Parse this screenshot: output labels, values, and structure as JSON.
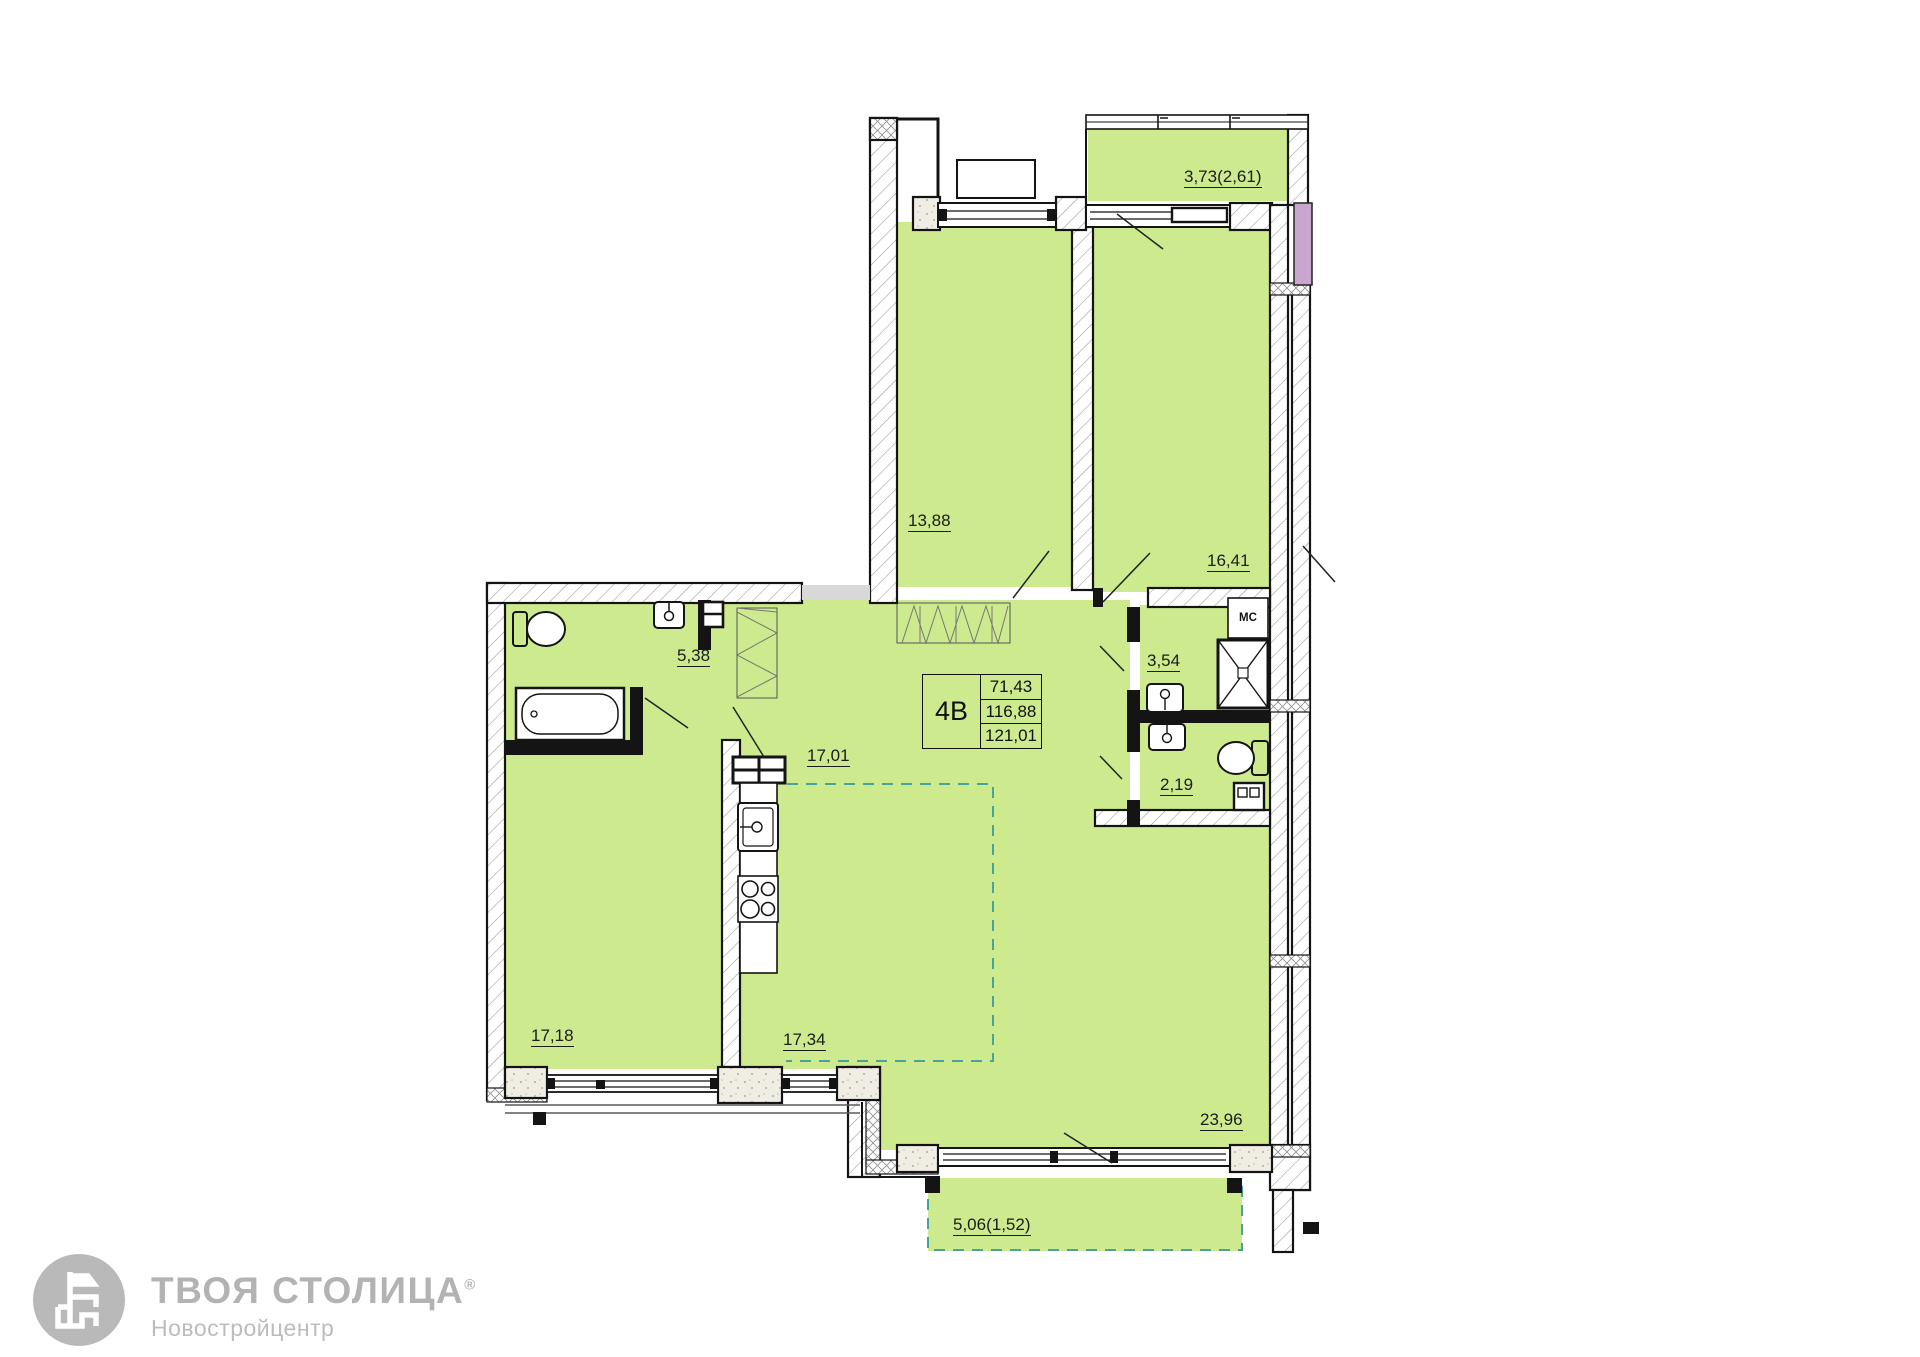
{
  "plan": {
    "unit": {
      "type_label": "4В",
      "area_living": "71,43",
      "area_total": "116,88",
      "area_with_balcony": "121,01"
    },
    "room_areas": {
      "bedroom_top": "13,88",
      "bedroom_right": "16,41",
      "loggia_top": "3,73(2,61)",
      "bathroom": "5,38",
      "hall": "17,01",
      "shower_room": "3,54",
      "wc": "2,19",
      "bedroom_bottom": "17,18",
      "kitchen": "17,34",
      "living_room": "23,96",
      "loggia_bottom": "5,06(1,52)"
    },
    "shaft_label": "МС"
  },
  "branding": {
    "company": "ТВОЯ СТОЛИЦА",
    "reg_mark": "®",
    "subtitle": "Новостройцентр"
  },
  "colors": {
    "room_fill": "#cdea8e",
    "neighbor_fill": "#c9a6cf",
    "zone_dash": "#4aa39b",
    "logo_gray": "#b3b3b3"
  }
}
